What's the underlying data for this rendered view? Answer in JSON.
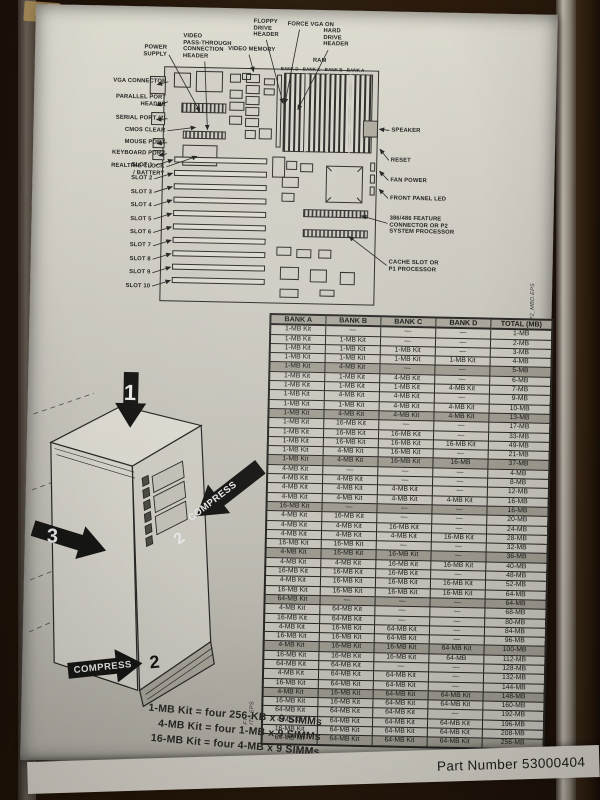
{
  "photo": {
    "part_number": "Part Number 53000404",
    "file_tags": {
      "board": "PP2_MBD.EPS",
      "tower": "FT-ITC.EPS"
    }
  },
  "diagram": {
    "labels": {
      "power_supply": "POWER\nSUPPLY",
      "vga_connector": "VGA CONNECTOR",
      "parallel_port_header": "PARALLEL PORT\nHEADER",
      "serial_port": "SERIAL PORT (2)",
      "cmos_clear": "CMOS CLEAR",
      "mouse_port": "MOUSE PORT",
      "keyboard_port": "KEYBOARD PORT",
      "realtime_clock": "REALTIME CLOCK\n/ BATTERY",
      "video_pass": "VIDEO\nPASS-THROUGH\nCONNECTION\nHEADER",
      "video_memory": "VIDEO MEMORY",
      "floppy": "FLOPPY\nDRIVE\nHEADER",
      "force_vga": "FORCE VGA ON",
      "hard_drive": "HARD\nDRIVE\nHEADER",
      "ram": "RAM",
      "speaker": "SPEAKER",
      "reset": "RESET",
      "fan_power": "FAN POWER",
      "front_panel_led": "FRONT PANEL LED",
      "feature_connector": "386/486 FEATURE\nCONNECTOR OR P2\nSYSTEM PROCESSOR",
      "cache_slot": "CACHE SLOT OR\nP1 PROCESSOR"
    },
    "bank_labels": [
      "BANK D",
      "BANK C",
      "BANK B",
      "BANK A"
    ],
    "slot_labels": [
      "SLOT 1",
      "SLOT 2",
      "SLOT 3",
      "SLOT 4",
      "SLOT 5",
      "SLOT 6",
      "SLOT 7",
      "SLOT 8",
      "SLOT 9",
      "SLOT 10"
    ]
  },
  "memory_table": {
    "headers": [
      "BANK A",
      "BANK B",
      "BANK C",
      "BANK D",
      "TOTAL (MB)"
    ],
    "rows": [
      [
        "1-MB Kit",
        "—",
        "—",
        "—",
        "1-MB"
      ],
      [
        "1-MB Kit",
        "1-MB Kit",
        "—",
        "—",
        "2-MB"
      ],
      [
        "1-MB Kit",
        "1-MB Kit",
        "1-MB Kit",
        "—",
        "3-MB"
      ],
      [
        "1-MB Kit",
        "1-MB Kit",
        "1-MB Kit",
        "1-MB Kit",
        "4-MB"
      ],
      [
        "1-MB Kit",
        "4-MB Kit",
        "—",
        "—",
        "5-MB"
      ],
      [
        "1-MB Kit",
        "1-MB Kit",
        "4-MB Kit",
        "—",
        "6-MB"
      ],
      [
        "1-MB Kit",
        "1-MB Kit",
        "1-MB Kit",
        "4-MB Kit",
        "7-MB"
      ],
      [
        "1-MB Kit",
        "4-MB Kit",
        "4-MB Kit",
        "—",
        "9-MB"
      ],
      [
        "1-MB Kit",
        "1-MB Kit",
        "4-MB Kit",
        "4-MB Kit",
        "10-MB"
      ],
      [
        "1-MB Kit",
        "4-MB Kit",
        "4-MB Kit",
        "4-MB Kit",
        "13-MB"
      ],
      [
        "1-MB Kit",
        "16-MB Kit",
        "—",
        "—",
        "17-MB"
      ],
      [
        "1-MB Kit",
        "16-MB Kit",
        "16-MB Kit",
        "—",
        "33-MB"
      ],
      [
        "1-MB Kit",
        "16-MB Kit",
        "16-MB Kit",
        "16-MB Kit",
        "49-MB"
      ],
      [
        "1-MB Kit",
        "4-MB Kit",
        "16-MB Kit",
        "—",
        "21-MB"
      ],
      [
        "1-MB Kit",
        "4-MB Kit",
        "16-MB Kit",
        "16-MB",
        "37-MB"
      ],
      [
        "4-MB Kit",
        "—",
        "—",
        "—",
        "4-MB"
      ],
      [
        "4-MB Kit",
        "4-MB Kit",
        "—",
        "—",
        "8-MB"
      ],
      [
        "4-MB Kit",
        "4-MB Kit",
        "4-MB Kit",
        "—",
        "12-MB"
      ],
      [
        "4-MB Kit",
        "4-MB Kit",
        "4-MB Kit",
        "4-MB Kit",
        "16-MB"
      ],
      [
        "16-MB Kit",
        "—",
        "—",
        "—",
        "16-MB"
      ],
      [
        "4-MB Kit",
        "16-MB Kit",
        "—",
        "—",
        "20-MB"
      ],
      [
        "4-MB Kit",
        "4-MB Kit",
        "16-MB Kit",
        "—",
        "24-MB"
      ],
      [
        "4-MB Kit",
        "4-MB Kit",
        "4-MB Kit",
        "16-MB Kit",
        "28-MB"
      ],
      [
        "16-MB Kit",
        "16-MB Kit",
        "—",
        "—",
        "32-MB"
      ],
      [
        "4-MB Kit",
        "16-MB Kit",
        "16-MB Kit",
        "—",
        "36-MB"
      ],
      [
        "4-MB Kit",
        "4-MB Kit",
        "16-MB Kit",
        "16-MB Kit",
        "40-MB"
      ],
      [
        "16-MB Kit",
        "16-MB Kit",
        "16-MB Kit",
        "—",
        "48-MB"
      ],
      [
        "4-MB Kit",
        "16-MB Kit",
        "16-MB Kit",
        "16-MB Kit",
        "52-MB"
      ],
      [
        "16-MB Kit",
        "16-MB Kit",
        "16-MB Kit",
        "16-MB Kit",
        "64-MB"
      ],
      [
        "64-MB Kit",
        "—",
        "—",
        "—",
        "64-MB"
      ],
      [
        "4-MB Kit",
        "64-MB Kit",
        "—",
        "—",
        "68-MB"
      ],
      [
        "16-MB Kit",
        "64-MB Kit",
        "—",
        "—",
        "80-MB"
      ],
      [
        "4-MB Kit",
        "16-MB Kit",
        "64-MB Kit",
        "—",
        "84-MB"
      ],
      [
        "16-MB Kit",
        "16-MB Kit",
        "64-MB Kit",
        "—",
        "96-MB"
      ],
      [
        "4-MB Kit",
        "16-MB Kit",
        "16-MB Kit",
        "64-MB Kit",
        "100-MB"
      ],
      [
        "16-MB Kit",
        "16-MB Kit",
        "16-MB Kit",
        "64-MB",
        "112-MB"
      ],
      [
        "64-MB Kit",
        "64-MB Kit",
        "—",
        "—",
        "128-MB"
      ],
      [
        "4-MB Kit",
        "64-MB Kit",
        "64-MB Kit",
        "—",
        "132-MB"
      ],
      [
        "16-MB Kit",
        "64-MB Kit",
        "64-MB Kit",
        "—",
        "144-MB"
      ],
      [
        "4-MB Kit",
        "16-MB Kit",
        "64-MB Kit",
        "64-MB Kit",
        "148-MB"
      ],
      [
        "16-MB Kit",
        "16-MB Kit",
        "64-MB Kit",
        "64-MB Kit",
        "160-MB"
      ],
      [
        "64-MB Kit",
        "64-MB Kit",
        "64-MB Kit",
        "—",
        "192-MB"
      ],
      [
        "4-MB Kit",
        "64-MB Kit",
        "64-MB Kit",
        "64-MB Kit",
        "196-MB"
      ],
      [
        "16-MB Kit",
        "64-MB Kit",
        "64-MB Kit",
        "64-MB Kit",
        "208-MB"
      ],
      [
        "64-MB Kit",
        "64-MB Kit",
        "64-MB Kit",
        "64-MB Kit",
        "256-MB"
      ]
    ]
  },
  "tower": {
    "step1": "1",
    "step2": "2",
    "step3": "3",
    "compress": "COMPRESS"
  },
  "legend": {
    "lines": [
      "1-MB Kit = four 256-KB x 9 SIMMs",
      "4-MB Kit = four 1-MB x 9 SIMMs",
      "16-MB Kit = four 4-MB x 9 SIMMs"
    ]
  }
}
